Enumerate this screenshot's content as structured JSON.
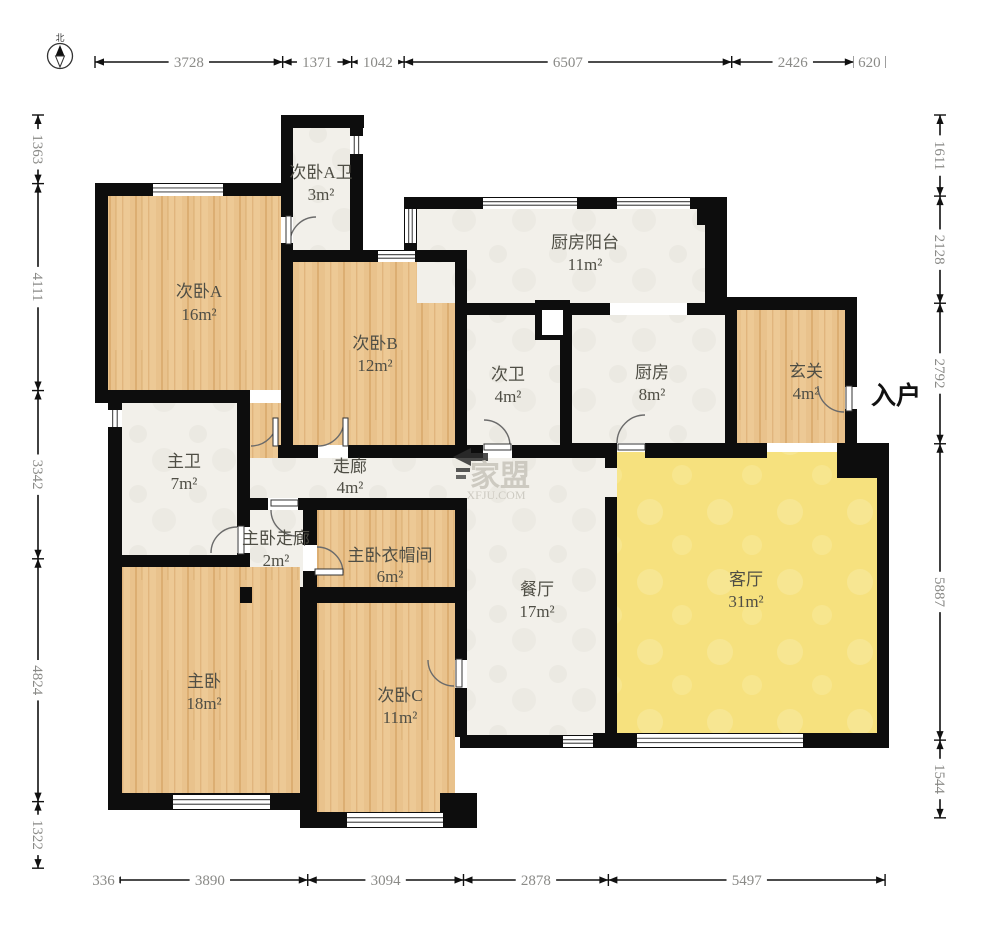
{
  "compass": {
    "north_label": "北"
  },
  "entrance": {
    "label": "入户"
  },
  "watermark": {
    "brand": "家盟",
    "site": "XFJU.COM"
  },
  "rooms": [
    {
      "id": "bedroomA-bath",
      "name": "次卧A卫",
      "area": "3m²",
      "cx": 321,
      "cy": 178,
      "acy": 200
    },
    {
      "id": "bedroomA",
      "name": "次卧A",
      "area": "16m²",
      "cx": 199,
      "cy": 297,
      "acy": 320
    },
    {
      "id": "bedroomB",
      "name": "次卧B",
      "area": "12m²",
      "cx": 375,
      "cy": 349,
      "acy": 371
    },
    {
      "id": "kitchen-balcony",
      "name": "厨房阳台",
      "area": "11m²",
      "cx": 585,
      "cy": 248,
      "acy": 270
    },
    {
      "id": "bath2",
      "name": "次卫",
      "area": "4m²",
      "cx": 508,
      "cy": 380,
      "acy": 402
    },
    {
      "id": "kitchen",
      "name": "厨房",
      "area": "8m²",
      "cx": 652,
      "cy": 378,
      "acy": 400
    },
    {
      "id": "foyer",
      "name": "玄关",
      "area": "4m²",
      "cx": 806,
      "cy": 377,
      "acy": 399
    },
    {
      "id": "master-bath",
      "name": "主卫",
      "area": "7m²",
      "cx": 184,
      "cy": 467,
      "acy": 489
    },
    {
      "id": "corridor",
      "name": "走廊",
      "area": "4m²",
      "cx": 350,
      "cy": 472,
      "acy": 493
    },
    {
      "id": "master-corridor",
      "name": "主卧走廊",
      "area": "2m²",
      "cx": 276,
      "cy": 544,
      "acy": 566
    },
    {
      "id": "master-closet",
      "name": "主卧衣帽间",
      "area": "6m²",
      "cx": 390,
      "cy": 561,
      "acy": 582
    },
    {
      "id": "dining",
      "name": "餐厅",
      "area": "17m²",
      "cx": 537,
      "cy": 595,
      "acy": 617
    },
    {
      "id": "living",
      "name": "客厅",
      "area": "31m²",
      "cx": 746,
      "cy": 585,
      "acy": 607
    },
    {
      "id": "master-bedroom",
      "name": "主卧",
      "area": "18m²",
      "cx": 204,
      "cy": 687,
      "acy": 709
    },
    {
      "id": "bedroomC",
      "name": "次卧C",
      "area": "11m²",
      "cx": 400,
      "cy": 701,
      "acy": 723
    }
  ],
  "dimensions": {
    "scale_px_per_mm": 0.05034,
    "top": {
      "axis": "h",
      "line": 62,
      "start": 95,
      "segments": [
        "3728",
        "1371",
        "1042",
        "6507",
        "2426",
        "620"
      ]
    },
    "bottom": {
      "axis": "h",
      "line": 880,
      "start": 95,
      "segments": [
        "336",
        "3890",
        "3094",
        "2878",
        "5497"
      ]
    },
    "left": {
      "axis": "v",
      "line": 38,
      "start": 115,
      "segments": [
        "1363",
        "4111",
        "3342",
        "4824",
        "1322"
      ]
    },
    "right": {
      "axis": "v",
      "line": 940,
      "start": 115,
      "segments": [
        "1611",
        "2128",
        "2792",
        "5887",
        "1544"
      ]
    }
  },
  "colors": {
    "wall": "#0d0d0d",
    "wood_base": "#e9c28c",
    "wood_streak": "#d8a96c",
    "wood_light": "#f0cf9d",
    "tile": "#f2f0ea",
    "tile_edge": "#e4e2da",
    "living": "#f6e17e",
    "living_patch": "#f9e99a",
    "dim_text": "#8a8a87",
    "label_text": "#4f4e45",
    "door_arc": "#6b6b6b",
    "watermark_text": "#c9c6bd",
    "watermark_arrow": "#2e2e2e"
  }
}
